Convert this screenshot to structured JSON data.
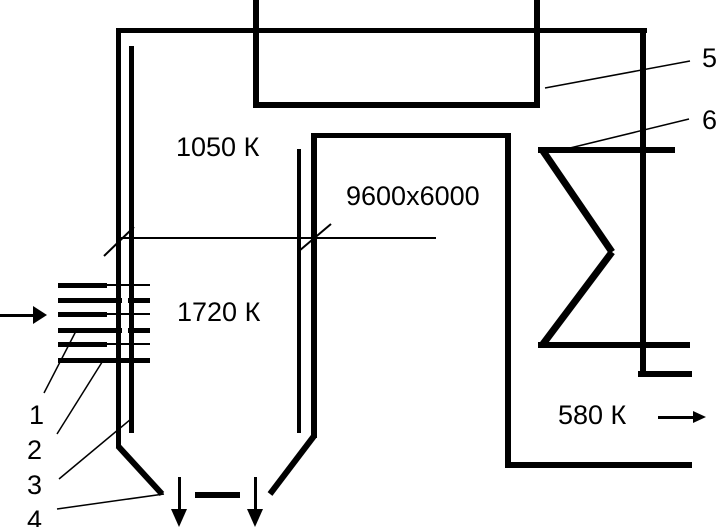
{
  "colors": {
    "line": "#000000",
    "background": "#ffffff"
  },
  "labels": {
    "temp_upper_pass": "1050 К",
    "duct_dimension": "9600x6000",
    "temp_furnace": "1720 К",
    "temp_outlet": "580 К"
  },
  "callouts": {
    "c1": "1",
    "c2": "2",
    "c3": "3",
    "c4": "4",
    "c5": "5",
    "c6": "6"
  },
  "icons": {
    "inlet_arrow": "arrow-right-icon",
    "outlet_arrow": "arrow-right-icon",
    "ash_arrow_left": "arrow-down-icon",
    "ash_arrow_right": "arrow-down-icon"
  }
}
